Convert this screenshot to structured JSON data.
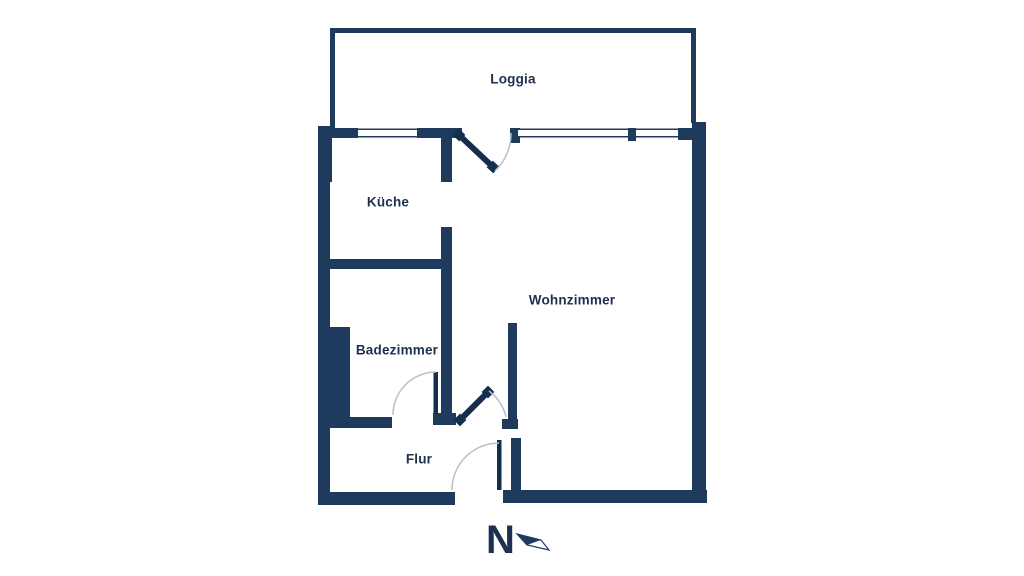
{
  "plan": {
    "rooms": [
      {
        "id": "loggia",
        "label": "Loggia"
      },
      {
        "id": "kueche",
        "label": "Küche"
      },
      {
        "id": "wohnzimmer",
        "label": "Wohnzimmer"
      },
      {
        "id": "badezimmer",
        "label": "Badezimmer"
      },
      {
        "id": "flur",
        "label": "Flur"
      }
    ],
    "compass": {
      "label": "N"
    }
  },
  "colors": {
    "wall": "#1e3a5c",
    "door": "#152e4d",
    "swing_arc": "#b5c0cd",
    "window_glass": "#ffffff",
    "background": "#ffffff",
    "label_text": "#1e3050"
  }
}
